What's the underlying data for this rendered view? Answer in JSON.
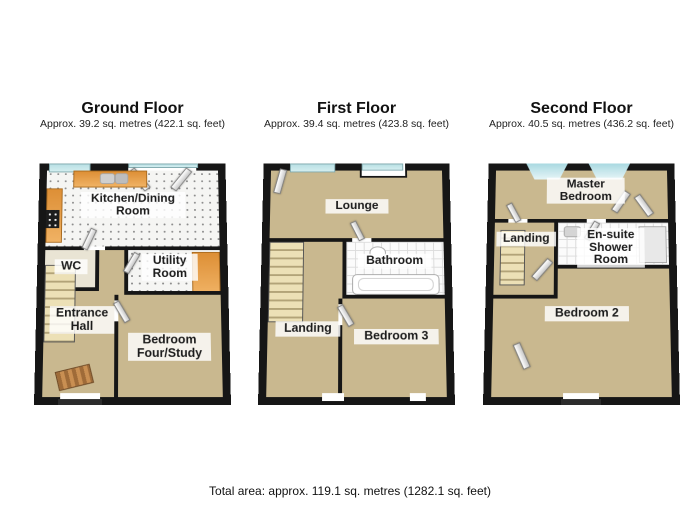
{
  "page": {
    "footer": "Total area: approx. 119.1 sq. metres (1282.1 sq. feet)"
  },
  "colors": {
    "wall": "#161616",
    "floor": "#c9b88f",
    "window": "#d4eef0",
    "counter": "#f0b264"
  },
  "floors": {
    "ground": {
      "title": "Ground Floor",
      "subtitle": "Approx. 39.2 sq. metres (422.1 sq. feet)",
      "rooms": {
        "kitchen": "Kitchen/Dining Room",
        "wc": "WC",
        "utility": "Utility Room",
        "hall": "Entrance Hall",
        "bed4": "Bedroom Four/Study"
      }
    },
    "first": {
      "title": "First Floor",
      "subtitle": "Approx. 39.4 sq. metres (423.8 sq. feet)",
      "rooms": {
        "lounge": "Lounge",
        "bathroom": "Bathroom",
        "landing": "Landing",
        "bed3": "Bedroom 3"
      }
    },
    "second": {
      "title": "Second Floor",
      "subtitle": "Approx. 40.5 sq. metres (436.2 sq. feet)",
      "rooms": {
        "master": "Master Bedroom",
        "landing": "Landing",
        "ensuite": "En-suite Shower Room",
        "bed2": "Bedroom 2"
      }
    }
  }
}
